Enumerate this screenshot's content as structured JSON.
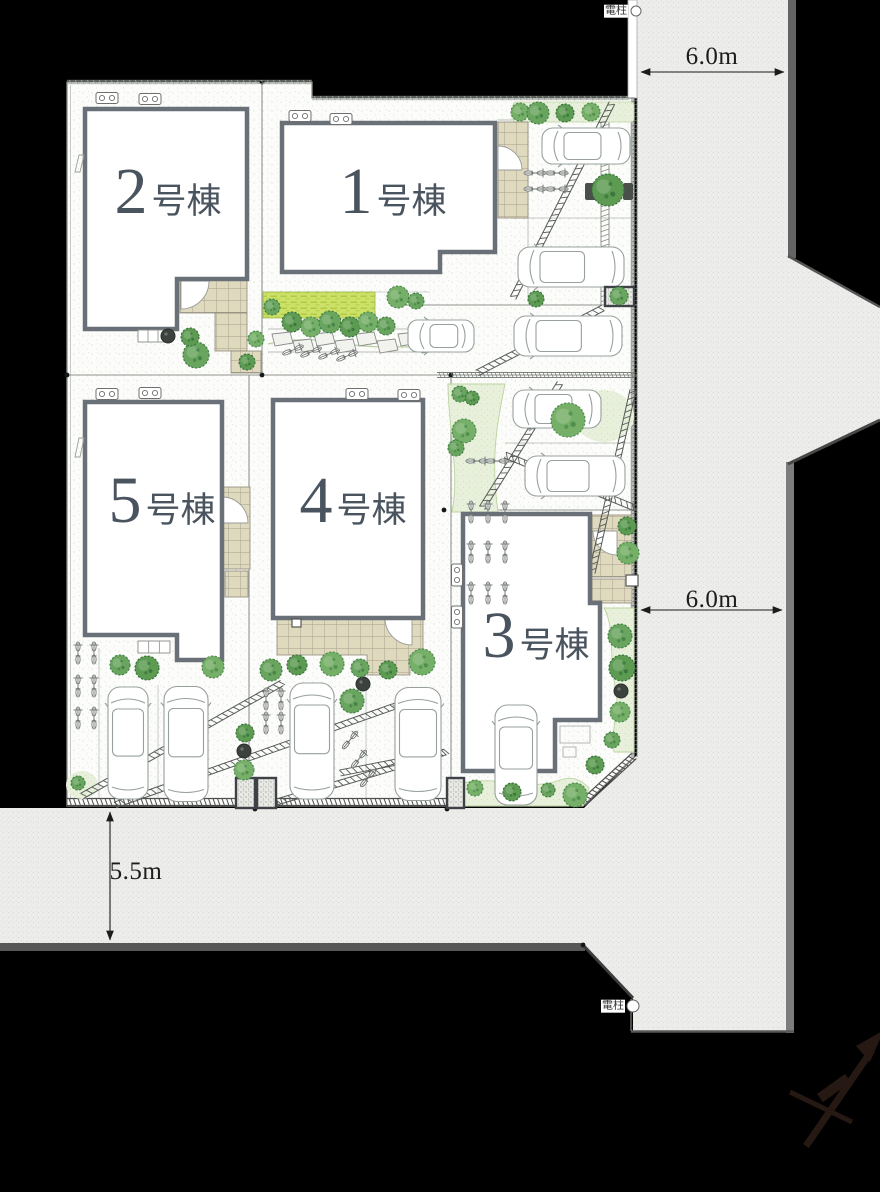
{
  "site_plan": {
    "title": "分譲住宅 区画図",
    "buildings": [
      {
        "key": "1",
        "number": "1",
        "suffix": "号棟"
      },
      {
        "key": "2",
        "number": "2",
        "suffix": "号棟"
      },
      {
        "key": "3",
        "number": "3",
        "suffix": "号棟"
      },
      {
        "key": "4",
        "number": "4",
        "suffix": "号棟"
      },
      {
        "key": "5",
        "number": "5",
        "suffix": "号棟"
      }
    ],
    "dimensions": [
      {
        "key": "top-road-width",
        "value": "6.0m"
      },
      {
        "key": "right-road-width",
        "value": "6.0m"
      },
      {
        "key": "bottom-road-width",
        "value": "5.5m"
      }
    ],
    "annotations": [
      {
        "key": "utility-pole-top",
        "label": "電柱"
      },
      {
        "key": "utility-pole-bottom",
        "label": "電柱"
      }
    ],
    "colors": {
      "background": "#000000",
      "road": "#ededeb",
      "road_edge": "#6e6e6e",
      "site": "#fcfcfa",
      "building_fill": "#ffffff",
      "building_border": "#6a7077",
      "label_text": "#4a545e",
      "tree_green": "#5d9b53",
      "lawn_green": "#cde168",
      "pale_green": "#e8f0dc",
      "tile_beige": "#dfd9be"
    }
  }
}
